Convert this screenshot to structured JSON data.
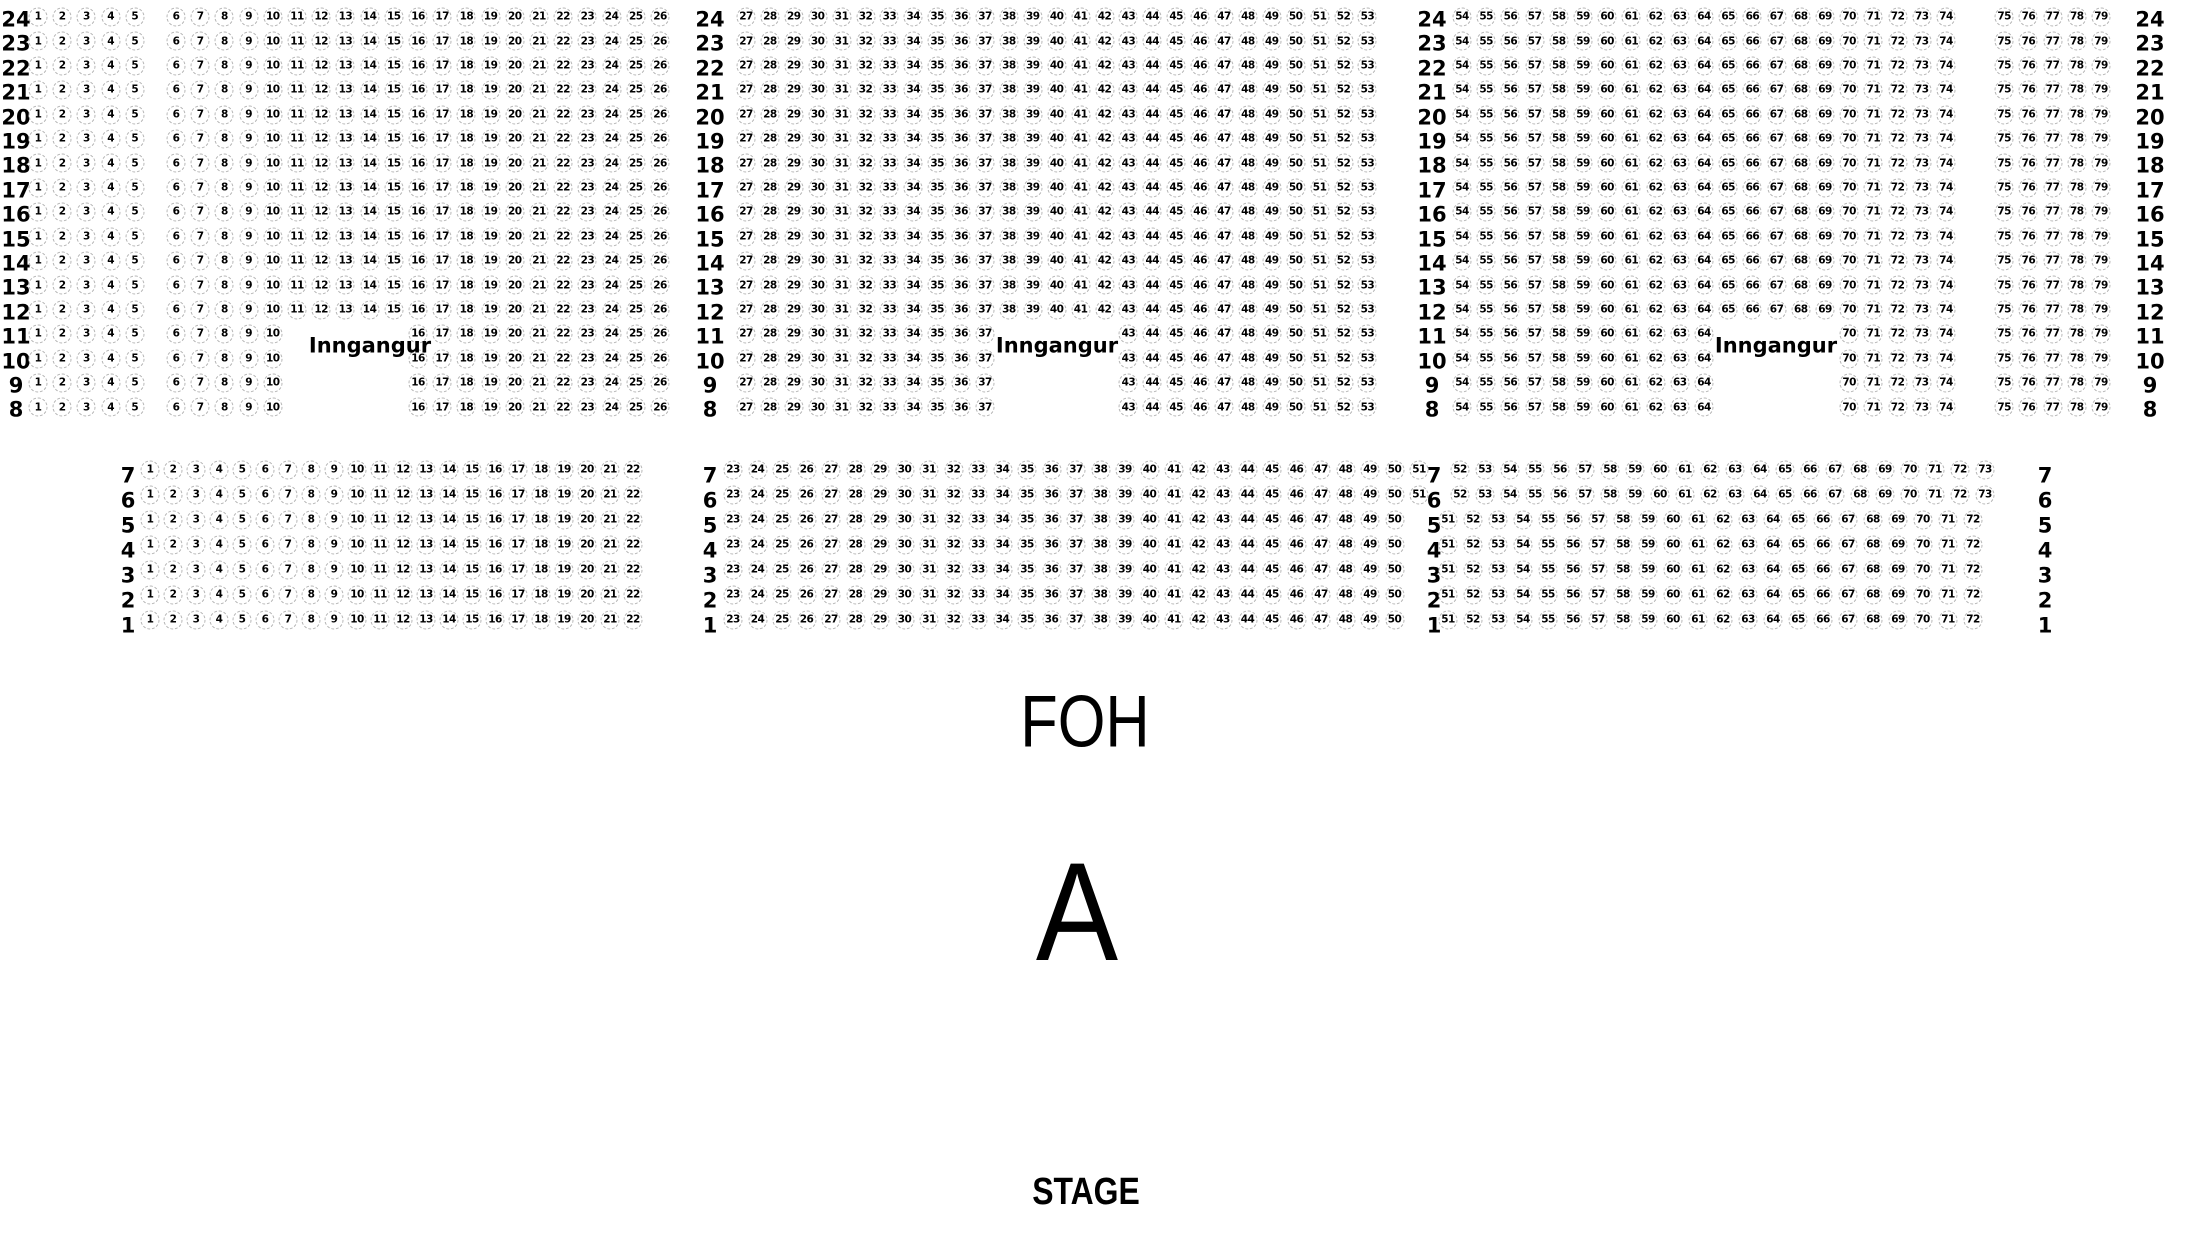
{
  "labels": {
    "foh": "FOH",
    "hall": "A",
    "stage": "STAGE"
  },
  "upper_section": {
    "entrance_labels": [
      "Inngangur",
      "Inngangur",
      "Inngangur"
    ],
    "row_groups": [
      {
        "row_labels": [
          24,
          23,
          22,
          21,
          20,
          19,
          18,
          17,
          16,
          15,
          14,
          13,
          12
        ],
        "seat_runs": [
          [
            1,
            5
          ],
          [
            6,
            26
          ],
          [
            27,
            53
          ],
          [
            54,
            74
          ],
          [
            75,
            79
          ]
        ]
      },
      {
        "row_labels": [
          11,
          10,
          9,
          8
        ],
        "seat_runs": [
          [
            1,
            5
          ],
          [
            6,
            10
          ],
          [
            16,
            26
          ],
          [
            27,
            37
          ],
          [
            43,
            53
          ],
          [
            54,
            64
          ],
          [
            70,
            74
          ],
          [
            75,
            79
          ]
        ]
      }
    ]
  },
  "lower_section": {
    "row_groups": [
      {
        "row_labels": [
          7,
          6
        ],
        "seat_runs": [
          [
            1,
            22
          ],
          [
            23,
            51
          ],
          [
            52,
            73
          ]
        ]
      },
      {
        "row_labels": [
          5,
          4,
          3,
          2,
          1
        ],
        "seat_runs": [
          [
            1,
            22
          ],
          [
            23,
            50
          ],
          [
            51,
            72
          ]
        ]
      }
    ]
  }
}
